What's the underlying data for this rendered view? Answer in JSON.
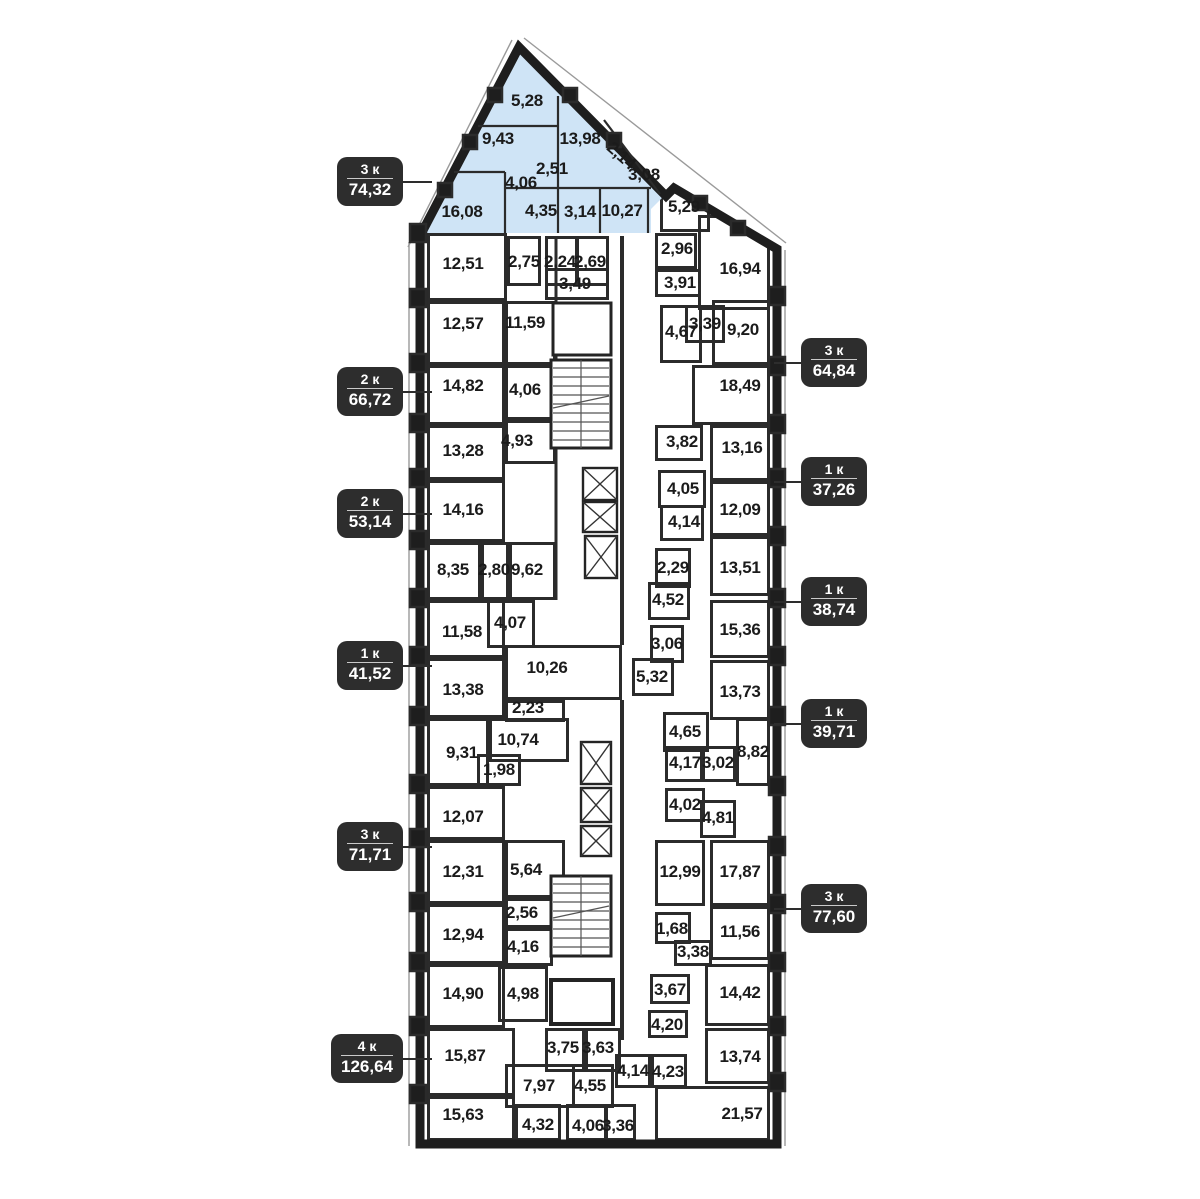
{
  "palette": {
    "wall": "#1e1e1e",
    "highlight_fill": "#cfe4f6",
    "badge_bg": "#2d2d2d",
    "badge_text": "#ffffff",
    "label_color": "#1b1b1b",
    "background": "#ffffff"
  },
  "selected_apartment": {
    "rooms_label": "3 к",
    "area": "74,32"
  },
  "badges": [
    {
      "side": "left",
      "rooms": "3 к",
      "area": "74,32",
      "x": 338,
      "y": 158
    },
    {
      "side": "left",
      "rooms": "2 к",
      "area": "66,72",
      "x": 338,
      "y": 368
    },
    {
      "side": "left",
      "rooms": "2 к",
      "area": "53,14",
      "x": 338,
      "y": 490
    },
    {
      "side": "left",
      "rooms": "1 к",
      "area": "41,52",
      "x": 338,
      "y": 642
    },
    {
      "side": "left",
      "rooms": "3 к",
      "area": "71,71",
      "x": 338,
      "y": 823
    },
    {
      "side": "left",
      "rooms": "4 к",
      "area": "126,64",
      "x": 332,
      "y": 1035
    },
    {
      "side": "right",
      "rooms": "3 к",
      "area": "64,84",
      "x": 802,
      "y": 339
    },
    {
      "side": "right",
      "rooms": "1 к",
      "area": "37,26",
      "x": 802,
      "y": 458
    },
    {
      "side": "right",
      "rooms": "1 к",
      "area": "38,74",
      "x": 802,
      "y": 578
    },
    {
      "side": "right",
      "rooms": "1 к",
      "area": "39,71",
      "x": 802,
      "y": 700
    },
    {
      "side": "right",
      "rooms": "3 к",
      "area": "77,60",
      "x": 802,
      "y": 885
    }
  ],
  "rooms": [
    {
      "t": "5,28",
      "x": 527,
      "y": 101,
      "hl": true
    },
    {
      "t": "9,43",
      "x": 498,
      "y": 139,
      "hl": true
    },
    {
      "t": "13,98",
      "x": 580,
      "y": 139,
      "hl": true
    },
    {
      "t": "2,14",
      "x": 621,
      "y": 156,
      "hl": true,
      "rot": 42
    },
    {
      "t": "2,51",
      "x": 552,
      "y": 169,
      "hl": true
    },
    {
      "t": "4,06",
      "x": 521,
      "y": 183,
      "hl": true
    },
    {
      "t": "3,08",
      "x": 644,
      "y": 175,
      "hl": true
    },
    {
      "t": "16,08",
      "x": 462,
      "y": 212,
      "hl": true
    },
    {
      "t": "4,35",
      "x": 541,
      "y": 211,
      "hl": true
    },
    {
      "t": "3,14",
      "x": 580,
      "y": 212,
      "hl": true
    },
    {
      "t": "10,27",
      "x": 622,
      "y": 211,
      "hl": true
    },
    {
      "t": "5,29",
      "x": 684,
      "y": 207,
      "b": [
        660,
        186,
        50,
        46
      ]
    },
    {
      "t": "2,96",
      "x": 677,
      "y": 249,
      "b": [
        655,
        233,
        42,
        36
      ]
    },
    {
      "t": "16,94",
      "x": 740,
      "y": 269,
      "b": [
        698,
        215,
        72,
        95
      ]
    },
    {
      "t": "3,91",
      "x": 680,
      "y": 283,
      "b": [
        655,
        269,
        46,
        28
      ]
    },
    {
      "t": "4,67",
      "x": 681,
      "y": 332,
      "b": [
        660,
        305,
        42,
        58
      ]
    },
    {
      "t": "3,39",
      "x": 705,
      "y": 324,
      "b": [
        685,
        305,
        40,
        38
      ]
    },
    {
      "t": "9,20",
      "x": 743,
      "y": 330,
      "b": [
        712,
        300,
        58,
        65
      ]
    },
    {
      "t": "18,49",
      "x": 740,
      "y": 386,
      "b": [
        692,
        365,
        78,
        60
      ]
    },
    {
      "t": "3,82",
      "x": 682,
      "y": 442,
      "b": [
        655,
        425,
        48,
        36
      ]
    },
    {
      "t": "13,16",
      "x": 742,
      "y": 448,
      "b": [
        710,
        425,
        60,
        56
      ]
    },
    {
      "t": "4,05",
      "x": 683,
      "y": 489,
      "b": [
        658,
        470,
        48,
        38
      ]
    },
    {
      "t": "12,09",
      "x": 740,
      "y": 510,
      "b": [
        710,
        481,
        60,
        55
      ]
    },
    {
      "t": "4,14",
      "x": 684,
      "y": 522,
      "b": [
        660,
        505,
        44,
        36
      ]
    },
    {
      "t": "2,29",
      "x": 673,
      "y": 568,
      "b": [
        655,
        548,
        36,
        40
      ]
    },
    {
      "t": "13,51",
      "x": 740,
      "y": 568,
      "b": [
        710,
        536,
        60,
        60
      ]
    },
    {
      "t": "4,52",
      "x": 668,
      "y": 600,
      "b": [
        648,
        582,
        42,
        38
      ]
    },
    {
      "t": "15,36",
      "x": 740,
      "y": 630,
      "b": [
        710,
        600,
        60,
        58
      ]
    },
    {
      "t": "3,06",
      "x": 667,
      "y": 644,
      "b": [
        650,
        625,
        34,
        38
      ]
    },
    {
      "t": "5,32",
      "x": 652,
      "y": 677,
      "b": [
        632,
        658,
        42,
        38
      ]
    },
    {
      "t": "13,73",
      "x": 740,
      "y": 692,
      "b": [
        710,
        660,
        60,
        60
      ]
    },
    {
      "t": "4,65",
      "x": 685,
      "y": 732,
      "b": [
        663,
        712,
        46,
        40
      ]
    },
    {
      "t": "4,17",
      "x": 685,
      "y": 763,
      "b": [
        665,
        746,
        40,
        36
      ]
    },
    {
      "t": "3,02",
      "x": 718,
      "y": 763,
      "b": [
        700,
        746,
        36,
        36
      ]
    },
    {
      "t": "8,82",
      "x": 753,
      "y": 752,
      "b": [
        736,
        718,
        34,
        68
      ]
    },
    {
      "t": "4,02",
      "x": 685,
      "y": 805,
      "b": [
        665,
        788,
        40,
        34
      ]
    },
    {
      "t": "4,81",
      "x": 718,
      "y": 818,
      "b": [
        700,
        800,
        36,
        38
      ]
    },
    {
      "t": "12,99",
      "x": 680,
      "y": 872,
      "b": [
        655,
        840,
        50,
        66
      ]
    },
    {
      "t": "17,87",
      "x": 740,
      "y": 872,
      "b": [
        710,
        840,
        60,
        66
      ]
    },
    {
      "t": "1,68",
      "x": 672,
      "y": 929,
      "b": [
        655,
        912,
        36,
        32
      ]
    },
    {
      "t": "11,56",
      "x": 740,
      "y": 932,
      "b": [
        710,
        906,
        60,
        54
      ]
    },
    {
      "t": "3,38",
      "x": 693,
      "y": 952,
      "b": [
        674,
        940,
        38,
        26
      ]
    },
    {
      "t": "3,67",
      "x": 670,
      "y": 990,
      "b": [
        650,
        974,
        40,
        30
      ]
    },
    {
      "t": "14,42",
      "x": 740,
      "y": 993,
      "b": [
        705,
        964,
        65,
        62
      ]
    },
    {
      "t": "4,20",
      "x": 667,
      "y": 1025,
      "b": [
        648,
        1010,
        40,
        28
      ]
    },
    {
      "t": "13,74",
      "x": 740,
      "y": 1057,
      "b": [
        705,
        1028,
        65,
        56
      ]
    },
    {
      "t": "4,14",
      "x": 633,
      "y": 1071,
      "b": [
        615,
        1054,
        36,
        34
      ]
    },
    {
      "t": "4,23",
      "x": 668,
      "y": 1072,
      "b": [
        651,
        1054,
        36,
        34
      ]
    },
    {
      "t": "21,57",
      "x": 742,
      "y": 1114,
      "b": [
        655,
        1086,
        115,
        55
      ]
    },
    {
      "t": "12,51",
      "x": 463,
      "y": 264,
      "b": [
        427,
        233,
        80,
        68
      ]
    },
    {
      "t": "2,75",
      "x": 524,
      "y": 262,
      "b": [
        507,
        236,
        34,
        50
      ]
    },
    {
      "t": "2,24",
      "x": 560,
      "y": 262,
      "b": [
        545,
        236,
        33,
        50
      ]
    },
    {
      "t": "2,69",
      "x": 590,
      "y": 262,
      "b": [
        576,
        236,
        33,
        50
      ]
    },
    {
      "t": "3,49",
      "x": 575,
      "y": 284,
      "b": [
        545,
        268,
        64,
        32
      ]
    },
    {
      "t": "11,59",
      "x": 525,
      "y": 323,
      "b": [
        505,
        301,
        51,
        64
      ]
    },
    {
      "t": "12,57",
      "x": 463,
      "y": 324,
      "b": [
        427,
        301,
        78,
        64
      ]
    },
    {
      "t": "14,82",
      "x": 463,
      "y": 386,
      "b": [
        427,
        365,
        78,
        60
      ]
    },
    {
      "t": "4,06",
      "x": 525,
      "y": 390,
      "b": [
        505,
        365,
        51,
        55
      ]
    },
    {
      "t": "13,28",
      "x": 463,
      "y": 451,
      "b": [
        427,
        425,
        78,
        55
      ]
    },
    {
      "t": "4,93",
      "x": 517,
      "y": 441,
      "b": [
        505,
        420,
        51,
        44
      ]
    },
    {
      "t": "14,16",
      "x": 463,
      "y": 510,
      "b": [
        427,
        480,
        78,
        62
      ]
    },
    {
      "t": "8,35",
      "x": 453,
      "y": 570,
      "b": [
        427,
        542,
        54,
        58
      ]
    },
    {
      "t": "2,80",
      "x": 494,
      "y": 570,
      "b": [
        481,
        542,
        28,
        58
      ]
    },
    {
      "t": "9,62",
      "x": 527,
      "y": 570,
      "b": [
        509,
        542,
        47,
        58
      ]
    },
    {
      "t": "11,58",
      "x": 462,
      "y": 632,
      "b": [
        427,
        600,
        78,
        58
      ]
    },
    {
      "t": "4,07",
      "x": 510,
      "y": 623,
      "b": [
        487,
        600,
        48,
        48
      ]
    },
    {
      "t": "13,38",
      "x": 463,
      "y": 690,
      "b": [
        427,
        658,
        78,
        60
      ]
    },
    {
      "t": "10,26",
      "x": 547,
      "y": 668,
      "b": [
        505,
        645,
        117,
        55
      ]
    },
    {
      "t": "2,23",
      "x": 528,
      "y": 708,
      "b": [
        505,
        700,
        60,
        22
      ]
    },
    {
      "t": "9,31",
      "x": 462,
      "y": 753,
      "b": [
        427,
        718,
        62,
        68
      ]
    },
    {
      "t": "10,74",
      "x": 518,
      "y": 740,
      "b": [
        489,
        718,
        80,
        44
      ]
    },
    {
      "t": "1,98",
      "x": 499,
      "y": 770,
      "b": [
        477,
        754,
        44,
        32
      ]
    },
    {
      "t": "12,07",
      "x": 463,
      "y": 817,
      "b": [
        427,
        786,
        78,
        54
      ]
    },
    {
      "t": "12,31",
      "x": 463,
      "y": 872,
      "b": [
        427,
        840,
        78,
        64
      ]
    },
    {
      "t": "5,64",
      "x": 526,
      "y": 870,
      "b": [
        505,
        840,
        60,
        58
      ]
    },
    {
      "t": "2,56",
      "x": 522,
      "y": 913,
      "b": [
        505,
        898,
        55,
        30
      ]
    },
    {
      "t": "12,94",
      "x": 463,
      "y": 935,
      "b": [
        427,
        904,
        78,
        60
      ]
    },
    {
      "t": "4,16",
      "x": 523,
      "y": 947,
      "b": [
        505,
        928,
        48,
        38
      ]
    },
    {
      "t": "14,90",
      "x": 463,
      "y": 994,
      "b": [
        427,
        964,
        78,
        64
      ]
    },
    {
      "t": "4,98",
      "x": 523,
      "y": 994,
      "b": [
        498,
        966,
        50,
        56
      ]
    },
    {
      "t": "15,87",
      "x": 465,
      "y": 1056,
      "b": [
        427,
        1028,
        88,
        68
      ]
    },
    {
      "t": "3,75",
      "x": 563,
      "y": 1048,
      "b": [
        545,
        1028,
        40,
        44
      ]
    },
    {
      "t": "3,63",
      "x": 598,
      "y": 1048,
      "b": [
        585,
        1028,
        36,
        44
      ]
    },
    {
      "t": "7,97",
      "x": 539,
      "y": 1086,
      "b": [
        505,
        1064,
        70,
        44
      ]
    },
    {
      "t": "4,55",
      "x": 590,
      "y": 1086,
      "b": [
        572,
        1064,
        42,
        44
      ]
    },
    {
      "t": "15,63",
      "x": 463,
      "y": 1115,
      "b": [
        427,
        1096,
        88,
        45
      ]
    },
    {
      "t": "4,32",
      "x": 538,
      "y": 1125,
      "b": [
        515,
        1104,
        46,
        37
      ]
    },
    {
      "t": "4,06",
      "x": 588,
      "y": 1126,
      "b": [
        566,
        1104,
        42,
        37
      ]
    },
    {
      "t": "3,36",
      "x": 618,
      "y": 1126,
      "b": [
        604,
        1104,
        32,
        37
      ]
    }
  ]
}
